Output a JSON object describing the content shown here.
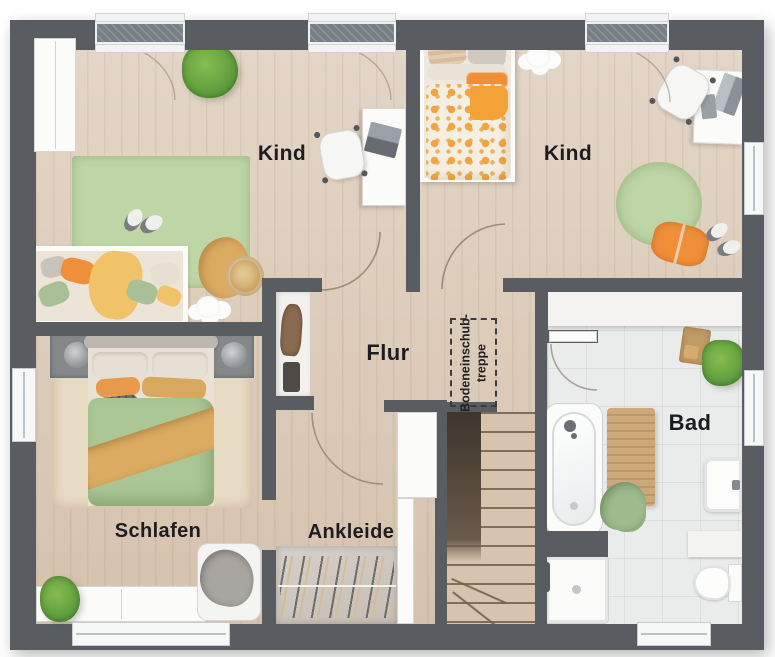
{
  "plan": {
    "rooms": [
      {
        "id": "kind-left",
        "label": "Kind"
      },
      {
        "id": "kind-right",
        "label": "Kind"
      },
      {
        "id": "flur",
        "label": "Flur"
      },
      {
        "id": "schlafen",
        "label": "Schlafen"
      },
      {
        "id": "ankleide",
        "label": "Ankleide"
      },
      {
        "id": "bad",
        "label": "Bad"
      }
    ],
    "attic_hatch": {
      "line1": "Bodeneinschub-",
      "line2": "treppe"
    },
    "colors": {
      "wall": "#595d61",
      "wood_floor": "#dccab6",
      "tile_floor": "#eaecec",
      "rug_green": "#bed5a5",
      "duvet_green": "#abc795",
      "accent_orange": "#ef8f3a",
      "blanket_tan": "#dcab62",
      "stairs_wood": "#d6c4af",
      "label_text": "#1d1d1f"
    }
  }
}
